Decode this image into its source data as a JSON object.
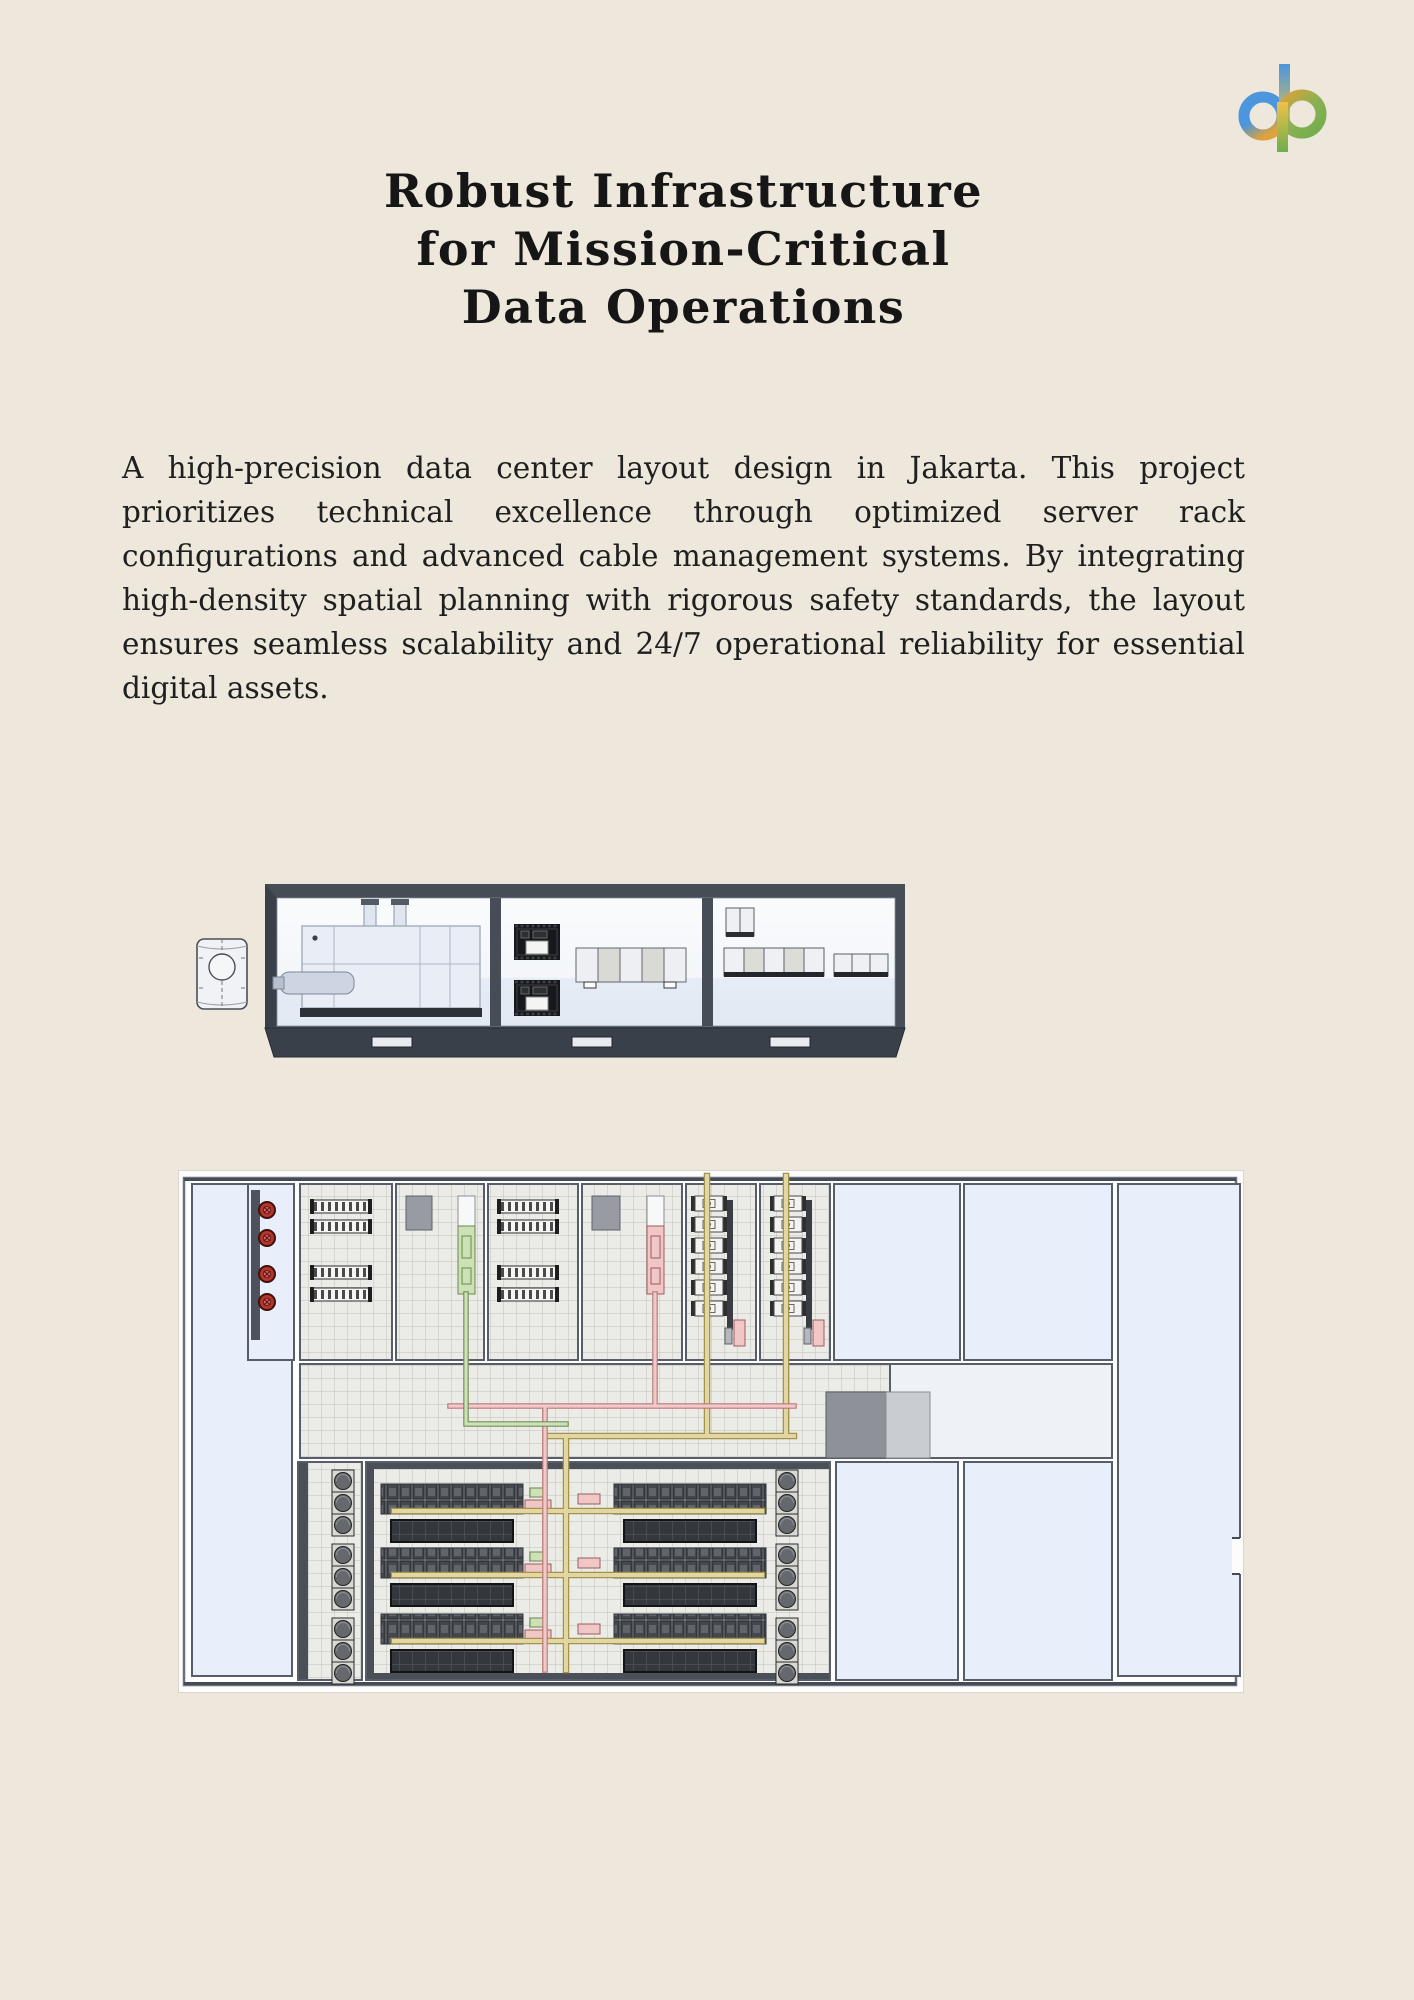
{
  "page": {
    "background_color": "#EDE7DC",
    "text_color": "#1f1f1f"
  },
  "logo": {
    "name": "dp-logo",
    "colors": {
      "blue": "#4b96dd",
      "gold": "#e8ab3c",
      "green": "#6fae4e"
    }
  },
  "title": {
    "line1": "Robust Infrastructure",
    "line2": "for Mission-Critical",
    "line3": "Data Operations"
  },
  "description": "A high-precision data center layout design in Jakarta. This project prioritizes technical excellence through optimized server rack configurations and advanced cable management systems. By integrating high-density spatial planning with rigorous safety standards, the layout ensures seamless scalability and 24/7 operational reliability for essential digital assets.",
  "figures": {
    "container_elevation": {
      "name": "modular-container-elevation-drawing",
      "elements": [
        "fuel-tank-cylinder",
        "generator-compartment",
        "transformer-compartment",
        "electrical-cabinet-compartment"
      ],
      "colors": {
        "wall": "#474D57",
        "interior": "#FAFBFD",
        "floor": "#E6ECF5",
        "equipment_dark": "#16181B"
      }
    },
    "floor_plan": {
      "name": "data-center-floor-plan-drawing",
      "elements": [
        "fire-valve-room",
        "battery-rooms",
        "switchgear-rooms",
        "pipe-corridor",
        "server-hall",
        "fan-wall-columns",
        "empty-rooms"
      ],
      "colors": {
        "room_blue": "#E9EFFA",
        "grid_floor": "#EBEBE7",
        "wall": "#575D69",
        "pipe_yellow": "#E2D6A2",
        "pipe_pink": "#F2C9C9",
        "pipe_green": "#CFE0BC",
        "valve_red": "#B23530",
        "rack_dark": "#44484E"
      }
    }
  }
}
